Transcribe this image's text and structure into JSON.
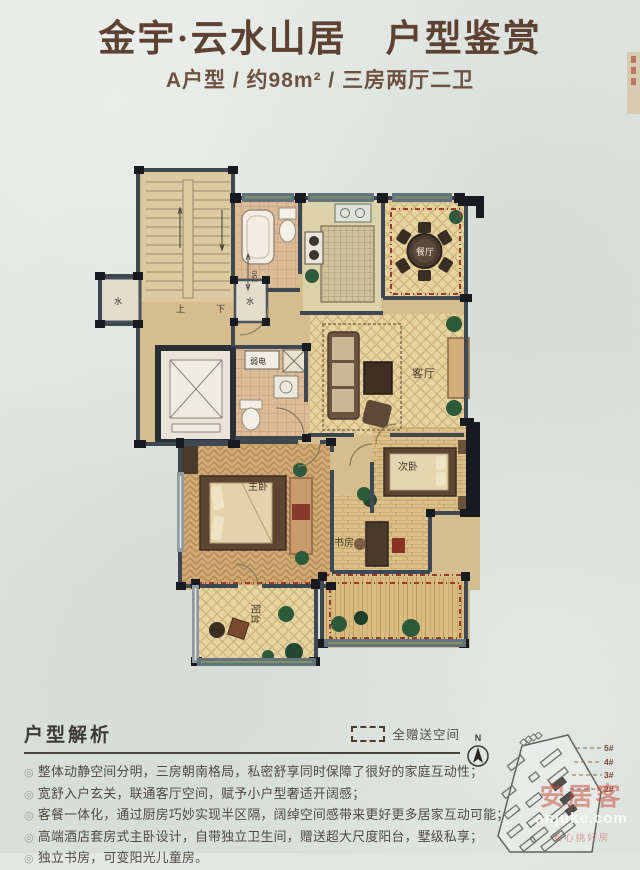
{
  "header": {
    "title": "金宇·云水山居　户型鉴赏",
    "subtitle": "A户型 / 约98m² / 三房两厅二卫"
  },
  "floorplan": {
    "rooms": {
      "dining": "餐厅",
      "living": "客厅",
      "master": "主卧",
      "second": "次卧",
      "study": "书房",
      "balcony": "阳台"
    },
    "annotations": {
      "up": "上",
      "down": "下",
      "water": "水",
      "weak_power": "弱电",
      "dim_750": "750"
    }
  },
  "legend": {
    "label": "全赠送空间"
  },
  "analysis": {
    "heading": "户型解析",
    "bullet_marker": "◎",
    "bullets": [
      "整体动静空间分明，三房朝南格局，私密舒享同时保障了很好的家庭互动性；",
      "宽舒入户玄关，联通客厅空间，赋予小户型奢适开阔感；",
      "客餐一体化，通过厨房巧妙实现半区隔，阔绰空间感带来更好更多居家互动可能；",
      "高端酒店套房式主卧设计，自带独立卫生间，赠送超大尺度阳台，墅级私享；",
      "独立书房，可变阳光儿童房。"
    ]
  },
  "siteplan": {
    "compass_label": "N",
    "building_labels": [
      "5#",
      "4#",
      "3#",
      "2#"
    ]
  },
  "watermark": {
    "brand": "安居客",
    "domain": "anjuke.com",
    "tagline": "安心挑好房"
  },
  "colors": {
    "title_text": "#5d4233",
    "wall": "#3e4852",
    "gift_dash": "#9c3a2a",
    "floor_tan": "#d6bd8e"
  }
}
